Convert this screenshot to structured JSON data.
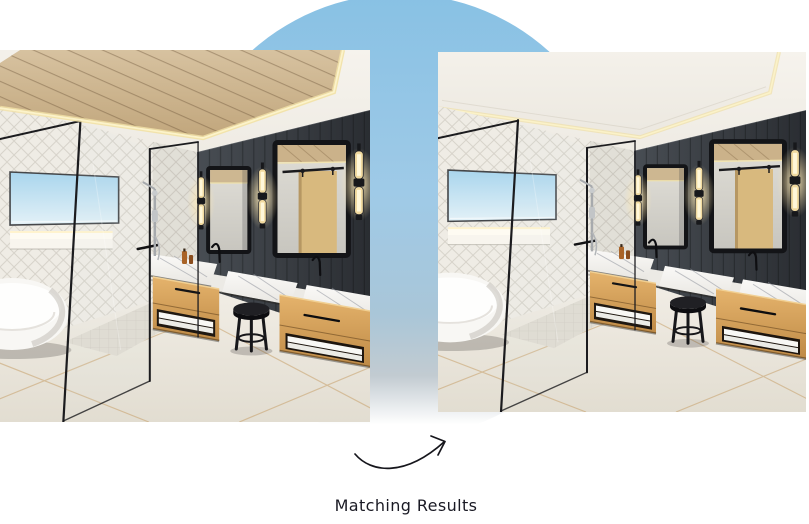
{
  "caption": {
    "text": "Matching Results"
  },
  "decor": {
    "circle_top_color": "#88C1E4",
    "circle_mid_color": "#A9C6D8",
    "circle_bottom_color": "#C2CBD1",
    "arrow_color": "#16161C",
    "caption_color": "#1A1A24"
  },
  "photos": [
    {
      "name": "bathroom-photo-left",
      "variant": "wood-plank-tray-ceiling"
    },
    {
      "name": "bathroom-photo-right",
      "variant": "plain-tray-ceiling"
    }
  ]
}
